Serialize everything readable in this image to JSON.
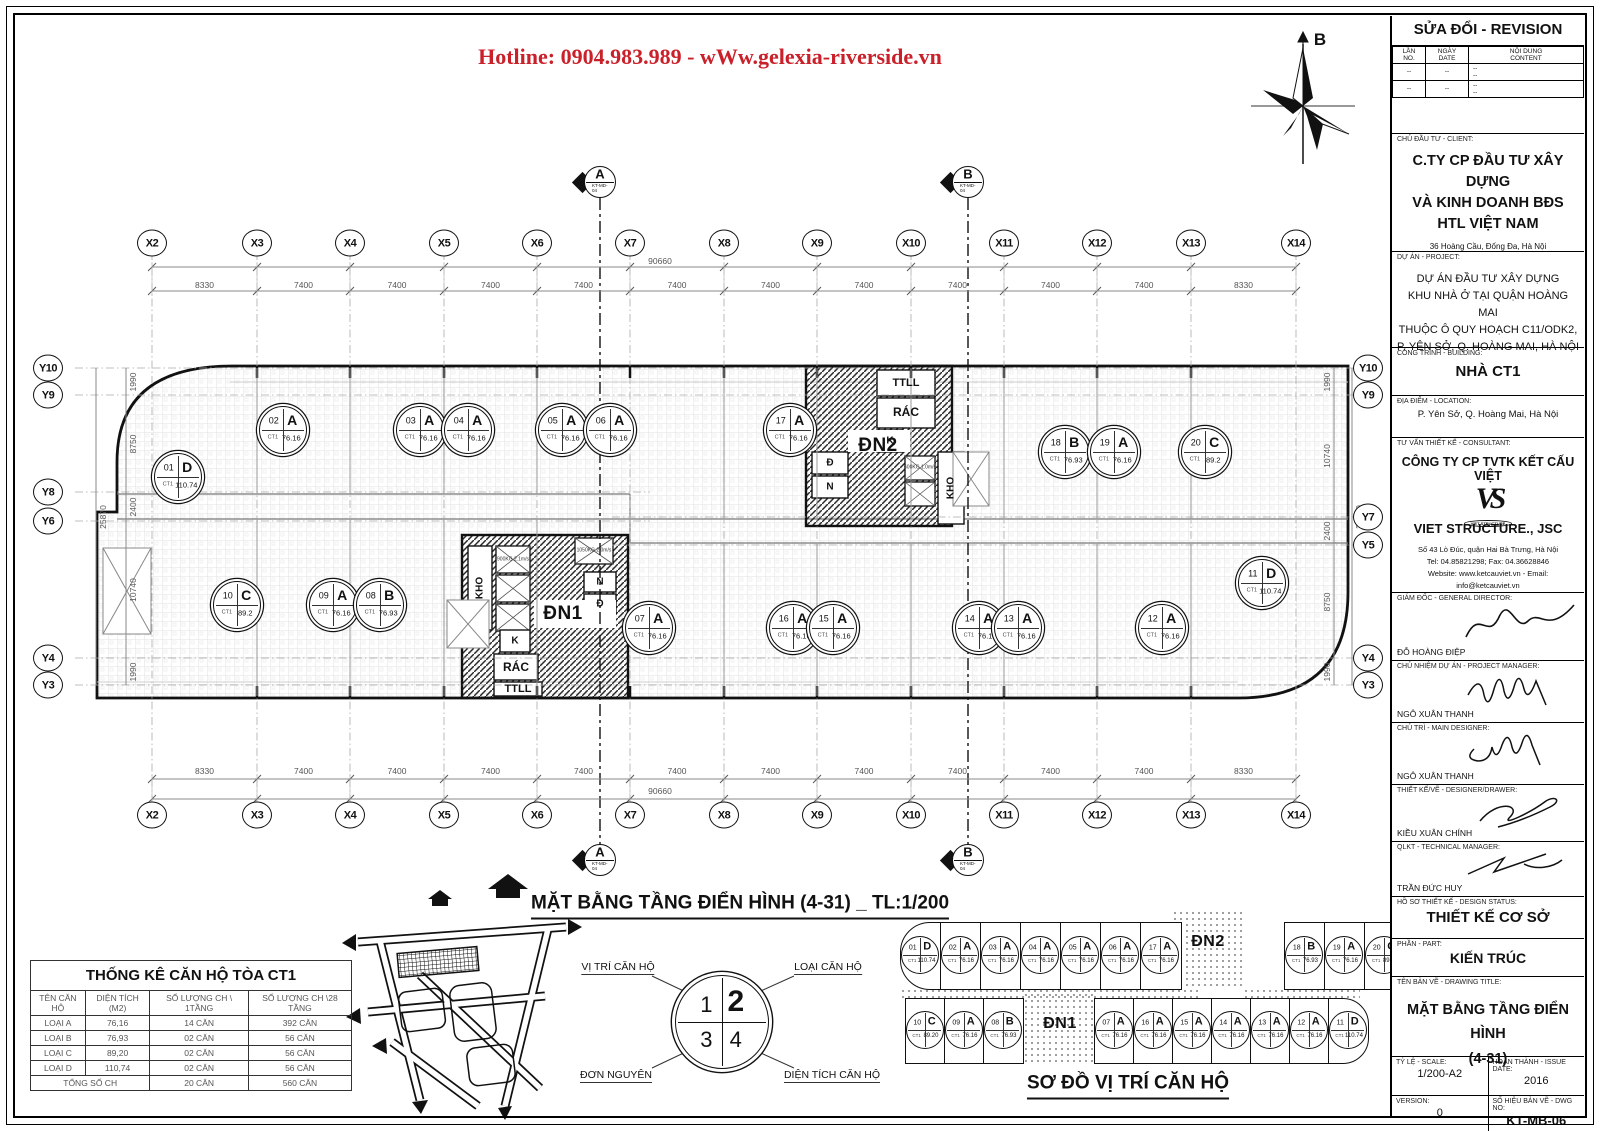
{
  "colors": {
    "accent_red": "#c9202a",
    "line": "#111111"
  },
  "hotline": "Hotline: 0904.983.989 - wWw.gelexia-riverside.vn",
  "compass_label": "B",
  "plan": {
    "title": "MẶT BẰNG TẦNG ĐIỂN HÌNH (4-31) _ TL:1/200",
    "section": {
      "a": "A",
      "b": "B",
      "ref": "KT-MD-04"
    },
    "unit_prefix": "CT1",
    "grid": {
      "x_labels": [
        "X2",
        "X3",
        "X4",
        "X5",
        "X6",
        "X7",
        "X8",
        "X9",
        "X10",
        "X11",
        "X12",
        "X13",
        "X14"
      ],
      "x_dims": [
        "8330",
        "7400",
        "7400",
        "7400",
        "7400",
        "7400",
        "7400",
        "7400",
        "7400",
        "7400",
        "7400",
        "8330"
      ],
      "x_total": "90660",
      "y_left_labels": [
        "Y10",
        "Y9",
        "Y8",
        "Y6",
        "Y4",
        "Y3"
      ],
      "y_left_dims": [
        "1990",
        "8750",
        "2400",
        "10740",
        "1990"
      ],
      "y_right_labels": [
        "Y10",
        "Y9",
        "Y7",
        "Y5",
        "Y4",
        "Y3"
      ],
      "y_right_dims": [
        "1990",
        "10740",
        "2400",
        "8750",
        "1990"
      ],
      "y_total": "25870"
    },
    "units": [
      {
        "no": "01",
        "type": "D",
        "area": "110.74",
        "x": 178,
        "y": 477
      },
      {
        "no": "02",
        "type": "A",
        "area": "76.16",
        "x": 283,
        "y": 430
      },
      {
        "no": "03",
        "type": "A",
        "area": "76.16",
        "x": 420,
        "y": 430
      },
      {
        "no": "04",
        "type": "A",
        "area": "76.16",
        "x": 468,
        "y": 430
      },
      {
        "no": "05",
        "type": "A",
        "area": "76.16",
        "x": 562,
        "y": 430
      },
      {
        "no": "06",
        "type": "A",
        "area": "76.16",
        "x": 610,
        "y": 430
      },
      {
        "no": "17",
        "type": "A",
        "area": "76.16",
        "x": 790,
        "y": 430
      },
      {
        "no": "18",
        "type": "B",
        "area": "76.93",
        "x": 1065,
        "y": 452
      },
      {
        "no": "19",
        "type": "A",
        "area": "76.16",
        "x": 1114,
        "y": 452
      },
      {
        "no": "20",
        "type": "C",
        "area": "89.2",
        "x": 1205,
        "y": 452
      },
      {
        "no": "10",
        "type": "C",
        "area": "89.2",
        "x": 237,
        "y": 605
      },
      {
        "no": "09",
        "type": "A",
        "area": "76.16",
        "x": 333,
        "y": 605
      },
      {
        "no": "08",
        "type": "B",
        "area": "76.93",
        "x": 380,
        "y": 605
      },
      {
        "no": "07",
        "type": "A",
        "area": "76.16",
        "x": 649,
        "y": 628
      },
      {
        "no": "16",
        "type": "A",
        "area": "76.16",
        "x": 793,
        "y": 628
      },
      {
        "no": "15",
        "type": "A",
        "area": "76.16",
        "x": 833,
        "y": 628
      },
      {
        "no": "14",
        "type": "A",
        "area": "76.16",
        "x": 979,
        "y": 628
      },
      {
        "no": "13",
        "type": "A",
        "area": "76.16",
        "x": 1018,
        "y": 628
      },
      {
        "no": "12",
        "type": "A",
        "area": "76.16",
        "x": 1162,
        "y": 628
      },
      {
        "no": "11",
        "type": "D",
        "area": "110.74",
        "x": 1262,
        "y": 583
      }
    ],
    "cores": {
      "dn1": {
        "label": "ĐN1",
        "kho": "KHO",
        "k": "K",
        "rac": "RÁC",
        "ttll": "TTLL",
        "n": "N",
        "d": "Đ",
        "lift1": "900KG 2.1m/s",
        "lift2": "1050KG 2.0m/s"
      },
      "dn2": {
        "label": "ĐN2",
        "ttll": "TTLL",
        "rac": "RÁC",
        "k": "K",
        "d": "Đ",
        "n": "N",
        "kho": "KHO",
        "lift1": "600KG 1.0m/s"
      }
    }
  },
  "legend": {
    "q1": "1",
    "q2": "2",
    "q3": "3",
    "q4": "4",
    "label_position": "VỊ TRÍ CĂN HỘ",
    "label_type": "LOẠI CĂN HỘ",
    "label_unit": "ĐƠN NGUYÊN",
    "label_area": "DIỆN TÍCH CĂN HỘ"
  },
  "stats_table": {
    "title": "THỐNG KÊ CĂN HỘ TÒA CT1",
    "headers": [
      "TÊN CĂN HỘ",
      "DIỆN TÍCH (M2)",
      "SỐ LƯỢNG CH \\ 1TẦNG",
      "SỐ LƯỢNG CH \\28 TẦNG"
    ],
    "rows": [
      [
        "LOẠI A",
        "76,16",
        "14 CĂN",
        "392 CĂN"
      ],
      [
        "LOẠI B",
        "76,93",
        "02 CĂN",
        "56 CĂN"
      ],
      [
        "LOẠI C",
        "89,20",
        "02 CĂN",
        "56 CĂN"
      ],
      [
        "LOẠI D",
        "110,74",
        "02 CĂN",
        "56 CĂN"
      ]
    ],
    "total_row": [
      "TỔNG SỐ CH",
      "20 CĂN",
      "560 CĂN"
    ]
  },
  "location_diagram": {
    "title": "SƠ ĐỒ VỊ TRÍ CĂN HỘ",
    "dn1_label": "ĐN1",
    "dn2_label": "ĐN2",
    "top_row": [
      {
        "no": "01",
        "type": "D",
        "area": "110.74"
      },
      {
        "no": "02",
        "type": "A",
        "area": "76.16"
      },
      {
        "no": "03",
        "type": "A",
        "area": "76.16"
      },
      {
        "no": "04",
        "type": "A",
        "area": "76.16"
      },
      {
        "no": "05",
        "type": "A",
        "area": "76.16"
      },
      {
        "no": "06",
        "type": "A",
        "area": "76.16"
      },
      {
        "no": "17",
        "type": "A",
        "area": "76.16"
      },
      {
        "no": "18",
        "type": "B",
        "area": "76.93"
      },
      {
        "no": "19",
        "type": "A",
        "area": "76.16"
      },
      {
        "no": "20",
        "type": "C",
        "area": "89.20"
      }
    ],
    "bottom_row": [
      {
        "no": "10",
        "type": "C",
        "area": "89.20"
      },
      {
        "no": "09",
        "type": "A",
        "area": "76.16"
      },
      {
        "no": "08",
        "type": "B",
        "area": "76.93"
      },
      {
        "no": "07",
        "type": "A",
        "area": "76.16"
      },
      {
        "no": "16",
        "type": "A",
        "area": "76.16"
      },
      {
        "no": "15",
        "type": "A",
        "area": "76.16"
      },
      {
        "no": "14",
        "type": "A",
        "area": "76.16"
      },
      {
        "no": "13",
        "type": "A",
        "area": "76.16"
      },
      {
        "no": "12",
        "type": "A",
        "area": "76.16"
      },
      {
        "no": "11",
        "type": "D",
        "area": "110.74"
      }
    ]
  },
  "title_block": {
    "revision": {
      "title": "SỬA ĐỔI - REVISION",
      "c1a": "LẦN",
      "c1b": "NO.",
      "c2a": "NGÀY",
      "c2b": "DATE",
      "c3a": "NỘI DUNG",
      "c3b": "CONTENT",
      "dash": "--"
    },
    "client": {
      "cap": "CHỦ ĐẦU TƯ - CLIENT:",
      "l1": "C.TY CP ĐẦU TƯ XÂY DỰNG",
      "l2": "VÀ KINH DOANH BĐS",
      "l3": "HTL VIỆT NAM",
      "addr": "36 Hoàng Cầu, Đống Đa, Hà Nội"
    },
    "project": {
      "cap": "DỰ ÁN - PROJECT:",
      "l1": "DỰ ÁN ĐẦU TƯ XÂY DỰNG",
      "l2": "KHU NHÀ Ở TẠI QUẬN HOÀNG MAI",
      "l3": "THUỘC Ô QUY HOẠCH C11/ODK2,",
      "l4": "P. YÊN SỞ, Q. HOÀNG MAI, HÀ NỘI"
    },
    "building": {
      "cap": "CÔNG TRÌNH - BUILDING:",
      "value": "NHÀ CT1"
    },
    "location": {
      "cap": "ĐỊA ĐIỂM - LOCATION:",
      "value": "P. Yên Sở, Q. Hoàng Mai, Hà Nội"
    },
    "consultant": {
      "cap": "TƯ VẤN THIẾT KẾ  -  CONSULTANT:",
      "company": "CÔNG TY CP TVTK KẾT CẤU VIỆT",
      "logo_vs": "VS",
      "logo_oval": "VIET STRUCTURE",
      "jsc": "VIET STRUCTURE., JSC",
      "addr": "Số 43 Lò Đúc, quận Hai Bà Trưng, Hà Nội",
      "tel": "Tel: 04.85821298; Fax: 04.36628846",
      "web": "Website: www.ketcauviet.vn - Email: info@ketcauviet.vn"
    },
    "director": {
      "cap": "GIÁM ĐỐC - GENERAL DIRECTOR:",
      "name": "ĐỖ HOÀNG ĐIỆP"
    },
    "pm": {
      "cap": "CHỦ NHIỆM DỰ ÁN - PROJECT MANAGER:",
      "name": "NGÔ XUÂN THANH"
    },
    "designer": {
      "cap": "CHỦ TRÌ - MAIN DESIGNER:",
      "name": "NGÔ XUÂN THANH"
    },
    "drawer": {
      "cap": "THIẾT KẾ/VẼ - DESIGNER/DRAWER:",
      "name": "KIỀU XUÂN CHÍNH"
    },
    "qlkt": {
      "cap": "QLKT - TECHNICAL MANAGER:",
      "name": "TRẦN ĐỨC HUY"
    },
    "status": {
      "cap": "HỒ SƠ THIẾT KẾ - DESIGN STATUS:",
      "value": "THIẾT KẾ CƠ SỞ"
    },
    "part": {
      "cap": "PHẦN - PART:",
      "value": "KIẾN TRÚC"
    },
    "drawing": {
      "cap": "TÊN BẢN VẼ - DRAWING TITLE:",
      "l1": "MẶT BẰNG TẦNG ĐIỂN HÌNH",
      "l2": "(4-31)"
    },
    "scale": {
      "cap": "TỶ LỆ - SCALE:",
      "value": "1/200-A2"
    },
    "issue": {
      "cap": "HOÀN THÀNH - ISSUE DATE:",
      "value": "2016"
    },
    "version": {
      "cap": "VERSION:",
      "value": "0"
    },
    "dwg": {
      "cap": "SỐ HIỆU BẢN VẼ - DWG NO:",
      "value": "KT-MB-06"
    }
  }
}
